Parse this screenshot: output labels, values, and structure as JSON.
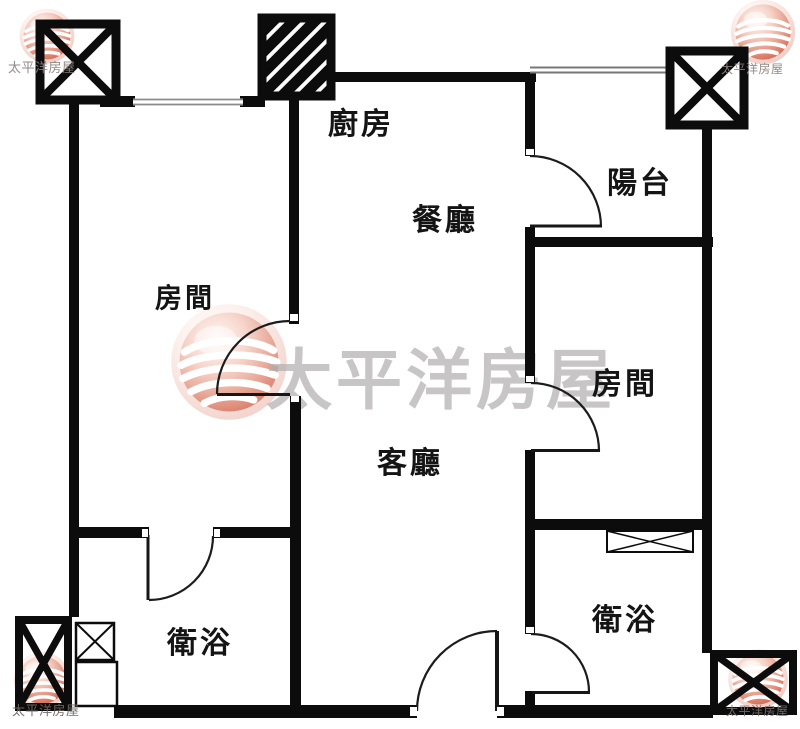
{
  "brand": {
    "name": "太平洋房屋",
    "watermark_center_text": "太平洋房屋",
    "watermark_corner_text": "太平洋房屋"
  },
  "rooms": [
    {
      "id": "kitchen",
      "label": "廚房"
    },
    {
      "id": "balcony",
      "label": "陽台"
    },
    {
      "id": "dining",
      "label": "餐廳"
    },
    {
      "id": "bedroom-left",
      "label": "房間"
    },
    {
      "id": "bedroom-right",
      "label": "房間"
    },
    {
      "id": "living",
      "label": "客廳"
    },
    {
      "id": "bathroom-left",
      "label": "衛浴"
    },
    {
      "id": "bathroom-right",
      "label": "衛浴"
    }
  ],
  "colors": {
    "wall": "#0c0c0c",
    "watermark_text": "#b2afaf",
    "logo_red": "#cf5a47"
  }
}
